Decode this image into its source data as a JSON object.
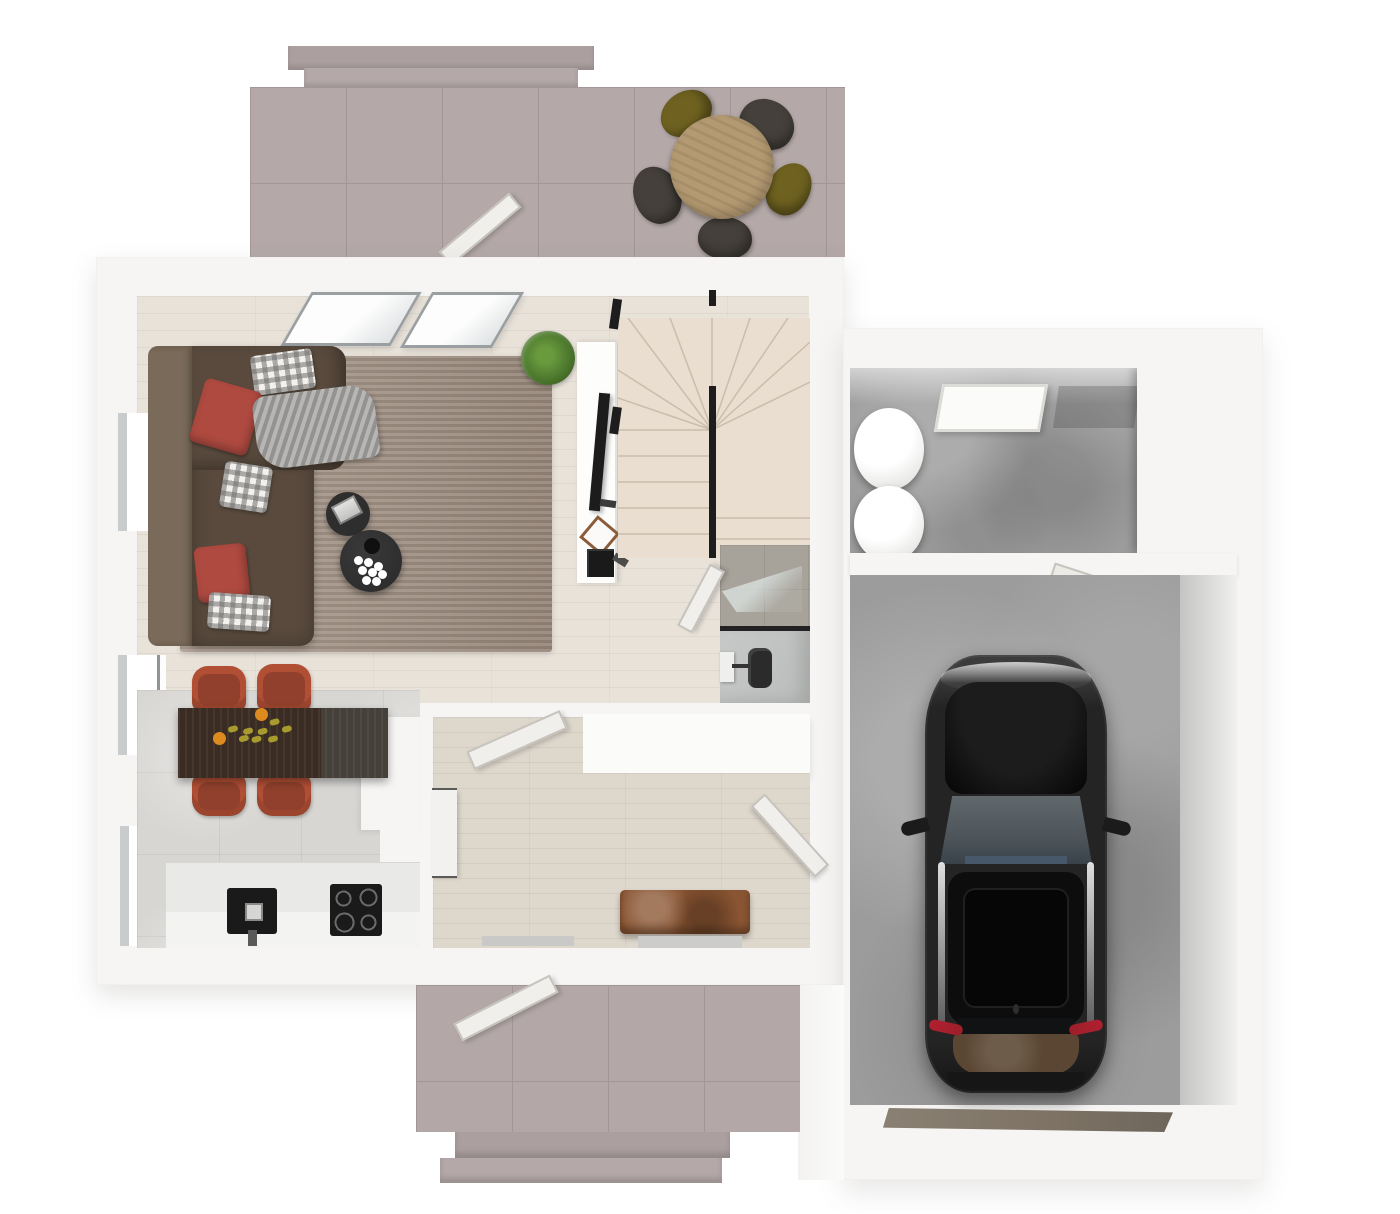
{
  "scene": {
    "kind": "3d-floor-plan-top-view",
    "canvas": {
      "width": 1400,
      "height": 1214
    },
    "visible_text": "none"
  },
  "palette": {
    "bg": "#ffffff",
    "wall": "#f6f5f4",
    "terrace-tile": "#b4a8a8",
    "terrace-tile-line": "#a29696",
    "terrace-step": "#ab9f9f",
    "wood-floor": "#e8e2d9",
    "rug": "#9c8b7d",
    "sofa": "#594a3d",
    "sofa-back": "#7a6a59",
    "pillow-red": "#ae4a40",
    "blanket": "#a3a2a0",
    "coffee-table": "#2e2e2e",
    "plant": "#4e7a2e",
    "sideboard": "#fdfdfc",
    "tv": "#1c1c1c",
    "frame-wood": "#8a5c3a",
    "stairs": "#e9decf",
    "rail": "#1d1d1d",
    "bath-wall-tile": "#a8a39a",
    "bath-wall-line": "#968f86",
    "bath-floor": "#b9bcba",
    "toilet": "#2b2b2b",
    "door-leaf": "#f1efec",
    "door-edge": "#c6c3bd",
    "cabinet": "#fbfbfa",
    "hall-floor": "#ded7cc",
    "bench": "#8a5532",
    "counter": "#ececea",
    "appliance": "#1a1a1a",
    "kitchen-tile": "#d7d6d3",
    "dining-table": "#3a2c22",
    "chair-rust": "#b14f35",
    "chair-rust-dark": "#90402c",
    "table-wood": "#b49a72",
    "chair-olive": "#6f6220",
    "chair-dark": "#45403b",
    "concrete": "#9c9c9c",
    "shelf-wood": "#8a7464",
    "shelf-line": "#6f5d4f",
    "cylinder": "#f7f7f5",
    "car-body": "#242424",
    "car-dark": "#0d0d0d",
    "car-glass": "#4a5258",
    "taillight": "#9c1f2a",
    "trunk": "#5a4632",
    "threshold": "#7d7264",
    "branch": "#a79a2f",
    "flower-orange": "#dd8a1e",
    "flower-white": "#ffffff"
  },
  "rooms": [
    {
      "id": "terrace",
      "furniture": [
        "round-dining-table",
        "chair-olive",
        "chair-olive",
        "chair-dark",
        "chair-dark",
        "chair-dark",
        "open-patio-door",
        "terrace-steps"
      ]
    },
    {
      "id": "living-room",
      "furniture": [
        "corner-sofa",
        "red-pillow",
        "red-pillow",
        "checked-pillow",
        "checked-pillow",
        "checked-pillow",
        "throw-blanket",
        "area-rug",
        "coffee-table-small",
        "coffee-table-large",
        "flower-vase",
        "potted-plant",
        "tv-sideboard",
        "flat-tv",
        "picture-frame",
        "media-box"
      ]
    },
    {
      "id": "staircase",
      "furniture": [
        "winder-stairs",
        "black-handrail"
      ]
    },
    {
      "id": "bathroom",
      "furniture": [
        "shower-glass",
        "toilet",
        "wash-basin",
        "open-door"
      ]
    },
    {
      "id": "kitchen",
      "furniture": [
        "counter",
        "sink",
        "cooktop",
        "dining-table",
        "chair-rust",
        "chair-rust",
        "chair-rust",
        "chair-rust",
        "flower-branch"
      ]
    },
    {
      "id": "hallway",
      "furniture": [
        "wardrobe-cabinet",
        "side-cabinet",
        "leather-bench",
        "open-door",
        "open-door",
        "doormat"
      ]
    },
    {
      "id": "storage-room",
      "furniture": [
        "water-tank",
        "water-tank",
        "skylight",
        "wood-shelf"
      ]
    },
    {
      "id": "garage",
      "furniture": [
        "black-car",
        "garage-door-threshold",
        "open-door"
      ]
    },
    {
      "id": "porch",
      "furniture": [
        "open-entry-door",
        "porch-steps"
      ]
    }
  ]
}
